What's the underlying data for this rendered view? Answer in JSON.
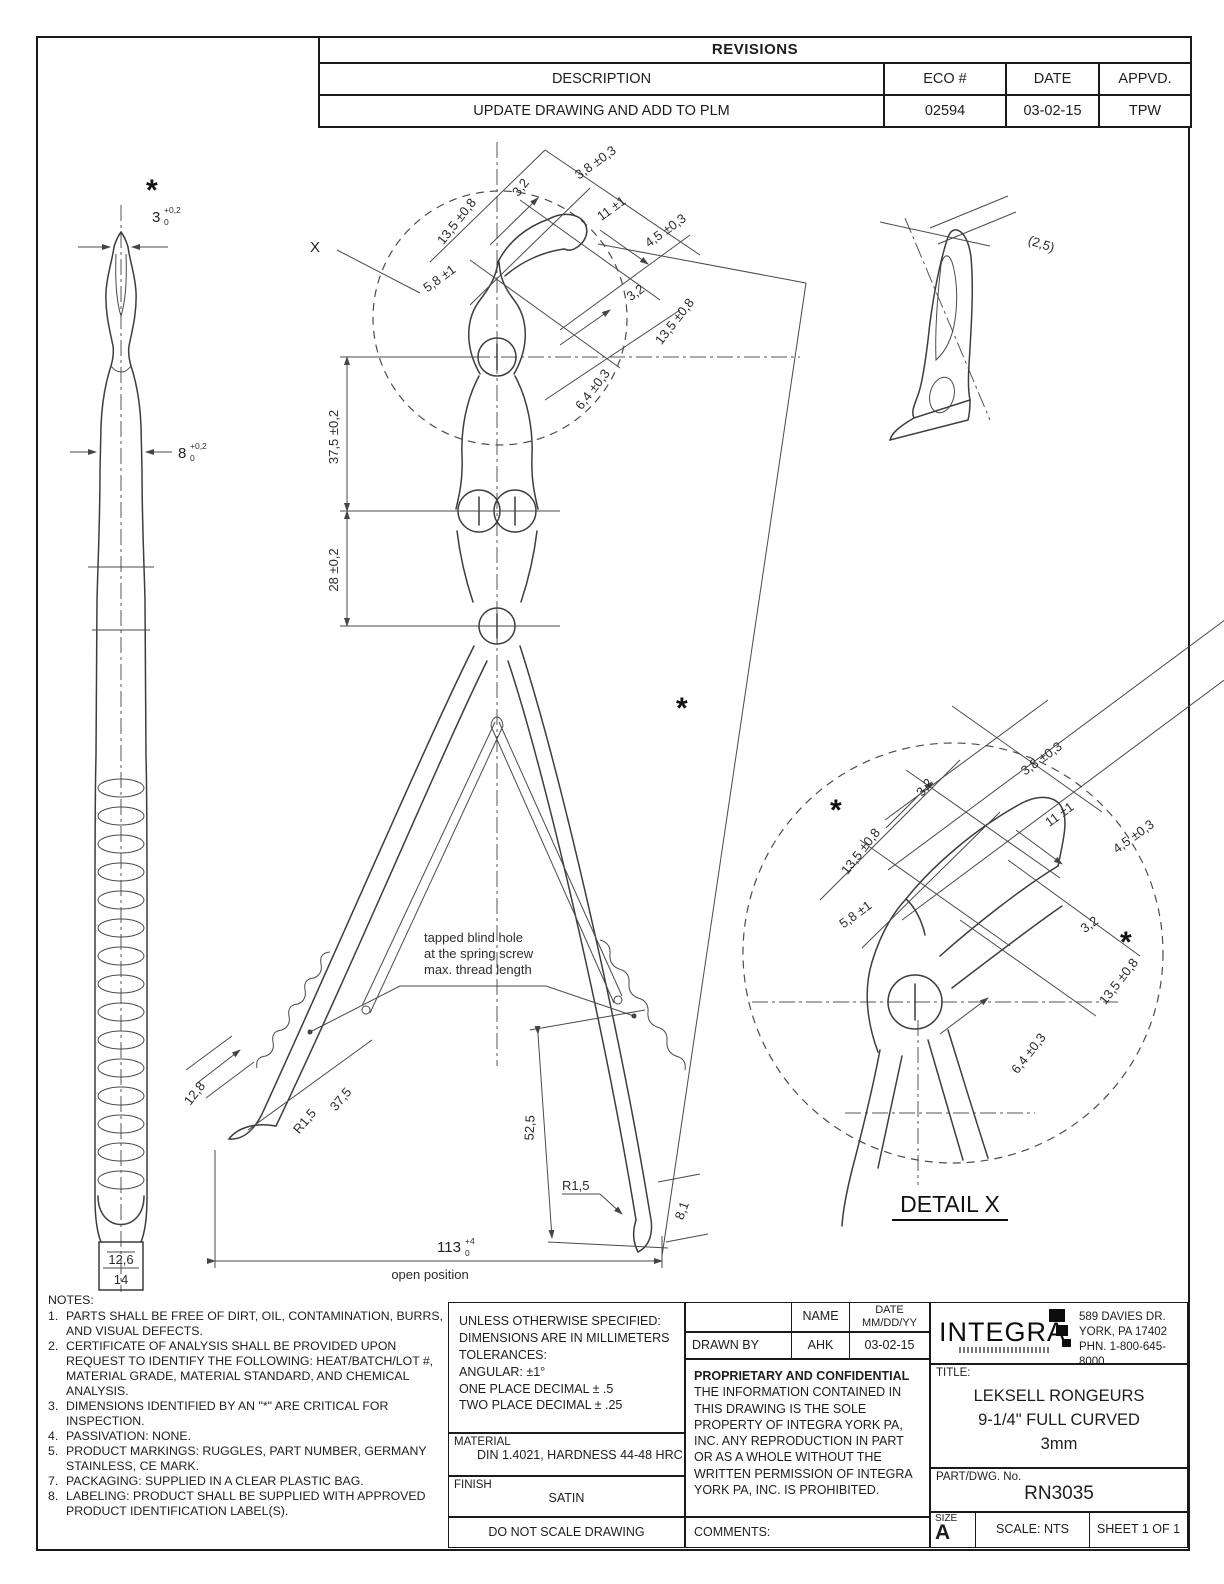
{
  "revisions": {
    "title": "REVISIONS",
    "headers": {
      "description": "DESCRIPTION",
      "eco": "ECO #",
      "date": "DATE",
      "appvd": "APPVD."
    },
    "rows": [
      {
        "description": "UPDATE DRAWING AND ADD TO PLM",
        "eco": "02594",
        "date": "03-02-15",
        "appvd": "TPW"
      }
    ]
  },
  "side_view": {
    "asterisk": "*",
    "tip_dim": "3",
    "tip_tol_hi": "+0,2",
    "tip_tol_lo": "0",
    "shaft_dim": "8",
    "shaft_tol_hi": "+0,2",
    "shaft_tol_lo": "0",
    "inner_width": "12,6",
    "outer_width": "14"
  },
  "main_view": {
    "detail_callout": "X",
    "asterisk": "*",
    "span_upper": "37,5 ±0,2",
    "span_lower": "28 ±0,2",
    "note_line1": "tapped blind hole",
    "note_line2": "at the spring screw",
    "note_line3": "max. thread length",
    "handle_offset": "12,8",
    "handle_radius": "R1,5",
    "handle_length": "37,5",
    "open_height": "52,5",
    "tip_radius": "R1,5",
    "tip_offset": "8,1",
    "open_width": "113",
    "open_width_tol_hi": "+4",
    "open_width_tol_lo": "0",
    "open_width_label": "open position"
  },
  "tip_view": {
    "thickness": "(2,5)"
  },
  "jaw_dims": {
    "asterisk": "*",
    "jaw_width": "13,5 ±0,8",
    "tip_width": "3,2",
    "cup_width": "3,8 ±0,3",
    "cup_length": "11 ±1",
    "cup_depth": "4,5 ±0,3",
    "neck_width": "5,8 ±1",
    "tip_width2": "3,2",
    "jaw_width2": "13,5 ±0,8",
    "cup_span": "6,4 ±0,3"
  },
  "detail_x": {
    "label": "DETAIL X"
  },
  "notes": {
    "heading": "NOTES:",
    "items": [
      {
        "num": "1.",
        "text": "PARTS SHALL BE FREE OF DIRT, OIL, CONTAMINATION, BURRS, AND VISUAL DEFECTS."
      },
      {
        "num": "2.",
        "text": "CERTIFICATE OF ANALYSIS SHALL BE PROVIDED UPON REQUEST TO IDENTIFY THE FOLLOWING: HEAT/BATCH/LOT #, MATERIAL GRADE, MATERIAL STANDARD, AND CHEMICAL ANALYSIS."
      },
      {
        "num": "3.",
        "text": "DIMENSIONS IDENTIFIED BY AN \"*\" ARE CRITICAL FOR INSPECTION."
      },
      {
        "num": "4.",
        "text": "PASSIVATION: NONE."
      },
      {
        "num": "5.",
        "text": "PRODUCT MARKINGS: RUGGLES, PART NUMBER, GERMANY STAINLESS, CE MARK."
      },
      {
        "num": "7.",
        "text": "PACKAGING: SUPPLIED IN A CLEAR PLASTIC BAG."
      },
      {
        "num": "8.",
        "text": "LABELING: PRODUCT SHALL BE SUPPLIED WITH APPROVED PRODUCT IDENTIFICATION LABEL(S)."
      }
    ]
  },
  "title_block": {
    "tol_line1": "UNLESS OTHERWISE SPECIFIED:",
    "tol_line2": "DIMENSIONS ARE IN MILLIMETERS",
    "tol_line3": "TOLERANCES:",
    "tol_line4": "ANGULAR: ±1°",
    "tol_line5": "ONE PLACE DECIMAL ± .5",
    "tol_line6": "TWO PLACE DECIMAL ± .25",
    "name_header": "NAME",
    "date_header": "DATE",
    "date_sub": "MM/DD/YY",
    "drawn_by_label": "DRAWN BY",
    "drawn_by_name": "AHK",
    "drawn_by_date": "03-02-15",
    "proprietary_title": "PROPRIETARY AND CONFIDENTIAL",
    "proprietary_body": "THE INFORMATION CONTAINED IN THIS DRAWING IS THE SOLE PROPERTY OF INTEGRA YORK PA, INC.  ANY REPRODUCTION IN PART OR AS A WHOLE WITHOUT THE WRITTEN PERMISSION OF INTEGRA YORK PA, INC. IS PROHIBITED.",
    "material_label": "MATERIAL",
    "material_value": "DIN 1.4021, HARDNESS 44-48 HRC",
    "finish_label": "FINISH",
    "finish_value": "SATIN",
    "do_not_scale": "DO NOT SCALE DRAWING",
    "comments_label": "COMMENTS:",
    "brand": "INTEGRA",
    "address_line1": "589 DAVIES DR.",
    "address_line2": "YORK, PA 17402",
    "address_line3": "PHN. 1-800-645-8000",
    "title_label": "TITLE:",
    "title_line1": "LEKSELL RONGEURS",
    "title_line2": "9-1/4\" FULL CURVED",
    "title_line3": "3mm",
    "part_label": "PART/DWG. No.",
    "part_number": "RN3035",
    "size_label": "SIZE",
    "size_value": "A",
    "scale": "SCALE: NTS",
    "sheet": "SHEET 1 OF 1"
  }
}
